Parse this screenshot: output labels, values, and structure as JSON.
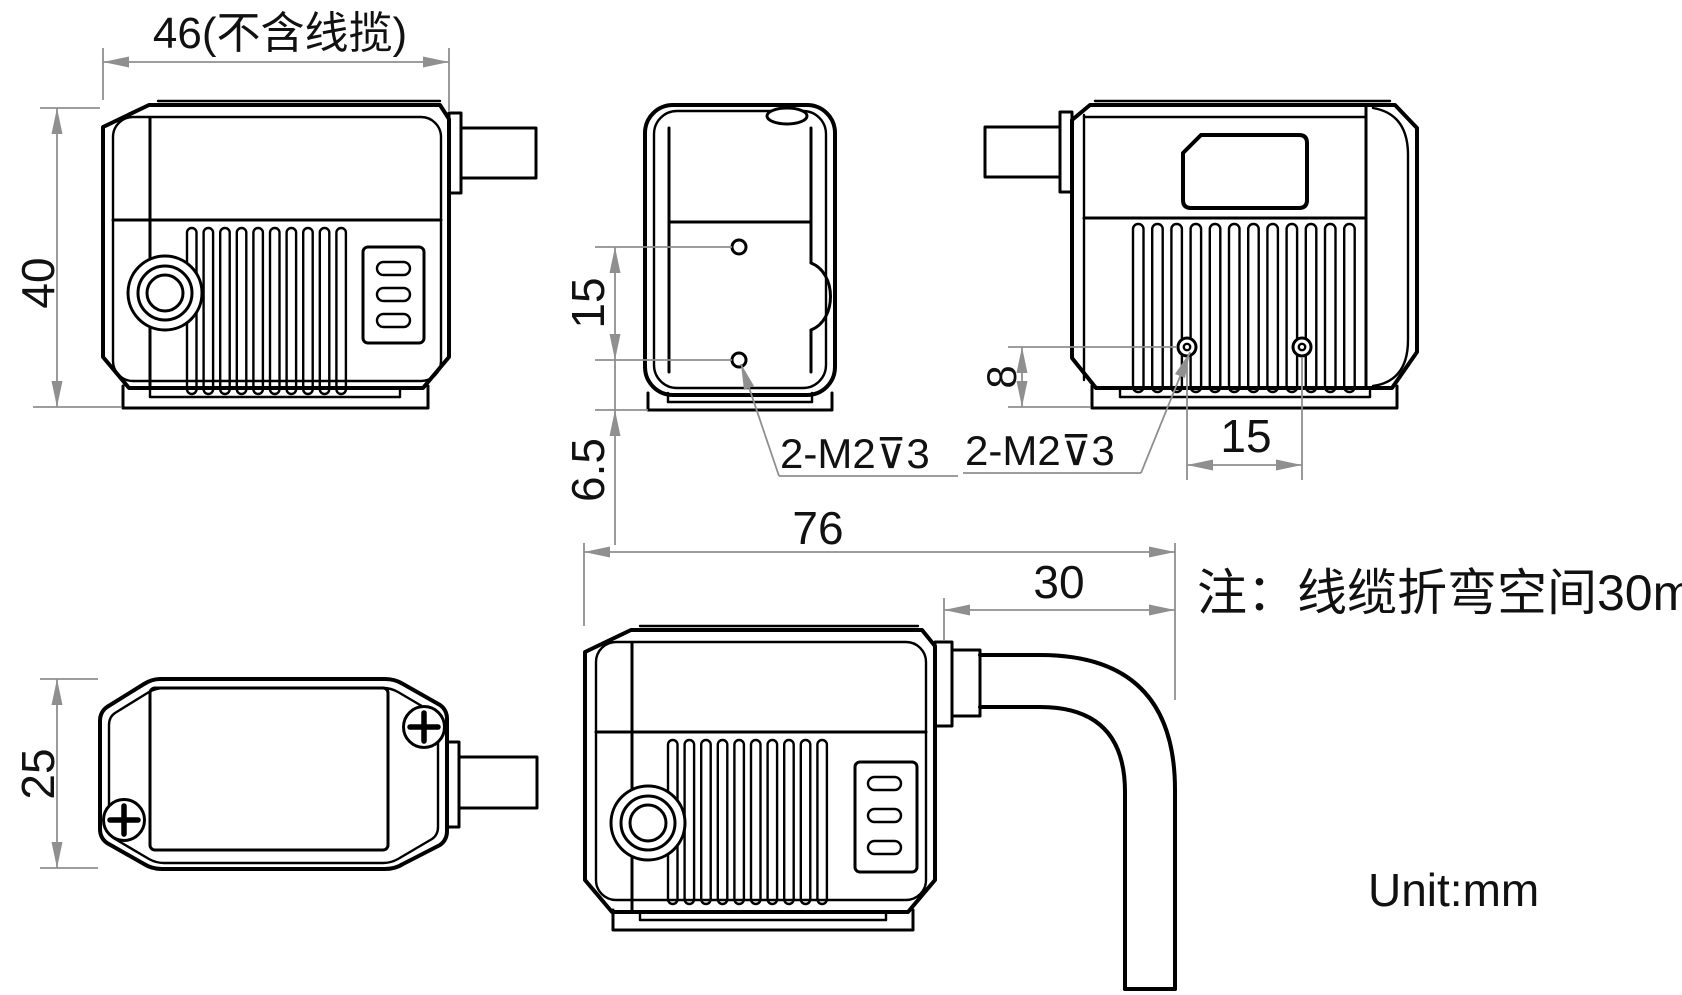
{
  "annotations": {
    "note": "注：线缆折弯空间30mm",
    "unit": "Unit:mm"
  },
  "dimensions": {
    "front_width": "46(不含线揽)",
    "front_height": "40",
    "side_hole_spacing": "15",
    "side_hole_bottom_offset": "6.5",
    "side_thread_callout": "2-M2⊽3",
    "rear_thread_callout": "2-M2⊽3",
    "rear_hole_bottom_offset": "8",
    "rear_hole_spacing": "15",
    "top_depth": "25",
    "overall_width_with_cable": "76",
    "cable_bend_space": "30"
  }
}
